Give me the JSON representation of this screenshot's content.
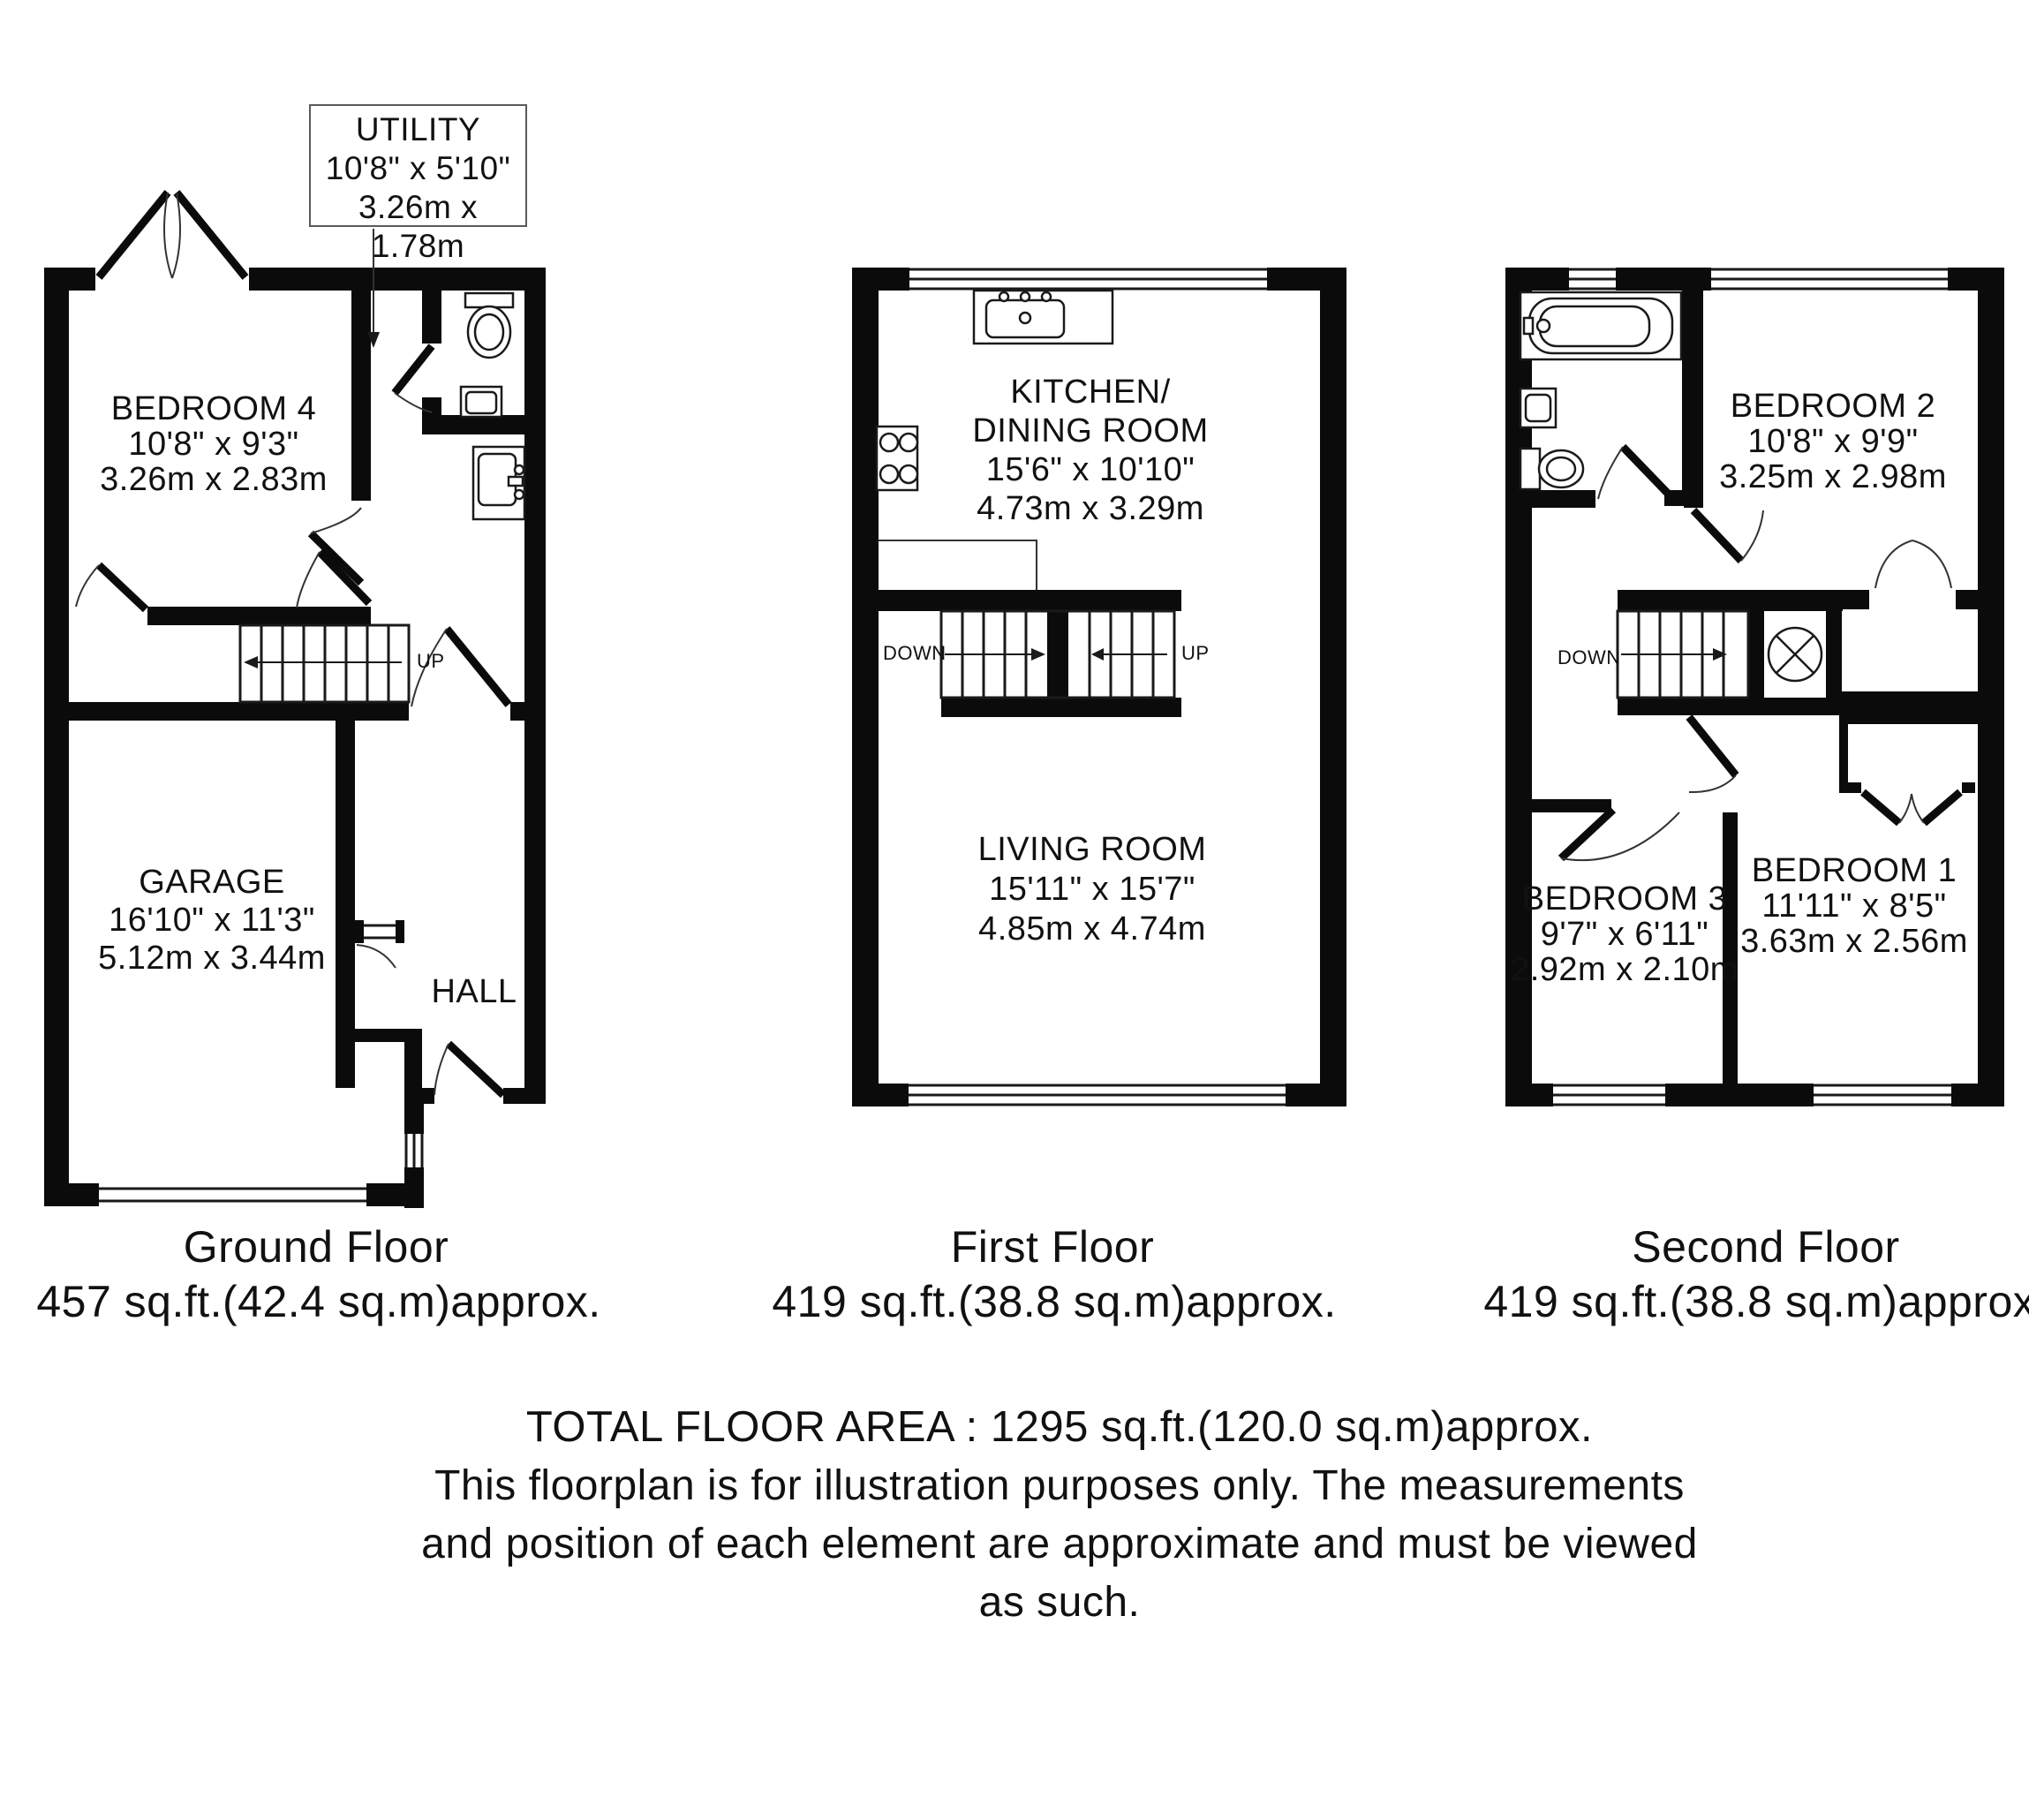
{
  "utility_callout": {
    "title": "UTILITY",
    "imperial": "10'8\" x 5'10\"",
    "metric": "3.26m x 1.78m"
  },
  "floors": {
    "ground": {
      "rooms": {
        "bedroom4": {
          "name": "BEDROOM 4",
          "imperial": "10'8\" x 9'3\"",
          "metric": "3.26m x 2.83m"
        },
        "garage": {
          "name": "GARAGE",
          "imperial": "16'10\" x 11'3\"",
          "metric": "5.12m x 3.44m"
        },
        "hall": {
          "name": "HALL"
        }
      },
      "stairs": {
        "up_label": "UP"
      },
      "caption": {
        "title": "Ground Floor",
        "area": "457 sq.ft.(42.4 sq.m)approx."
      }
    },
    "first": {
      "rooms": {
        "kitchen_dining": {
          "name_line1": "KITCHEN/",
          "name_line2": "DINING ROOM",
          "imperial": "15'6\" x 10'10\"",
          "metric": "4.73m x 3.29m"
        },
        "living": {
          "name": "LIVING ROOM",
          "imperial": "15'11\" x 15'7\"",
          "metric": "4.85m x 4.74m"
        }
      },
      "stairs": {
        "down_label": "DOWN",
        "up_label": "UP"
      },
      "caption": {
        "title": "First Floor",
        "area": "419 sq.ft.(38.8 sq.m)approx."
      }
    },
    "second": {
      "rooms": {
        "bedroom2": {
          "name": "BEDROOM 2",
          "imperial": "10'8\" x 9'9\"",
          "metric": "3.25m x 2.98m"
        },
        "bedroom3": {
          "name": "BEDROOM 3",
          "imperial": "9'7\" x 6'11\"",
          "metric": "2.92m x 2.10m"
        },
        "bedroom1": {
          "name": "BEDROOM 1",
          "imperial": "11'11\" x 8'5\"",
          "metric": "3.63m x 2.56m"
        }
      },
      "stairs": {
        "down_label": "DOWN"
      },
      "caption": {
        "title": "Second Floor",
        "area": "419 sq.ft.(38.8 sq.m)approx."
      }
    }
  },
  "footer": {
    "total": "TOTAL FLOOR AREA : 1295 sq.ft.(120.0 sq.m)approx.",
    "disclaimer_lines": [
      "This floorplan is for illustration purposes only. The measurements",
      "and position of each element are approximate and must be viewed",
      "as such."
    ]
  }
}
